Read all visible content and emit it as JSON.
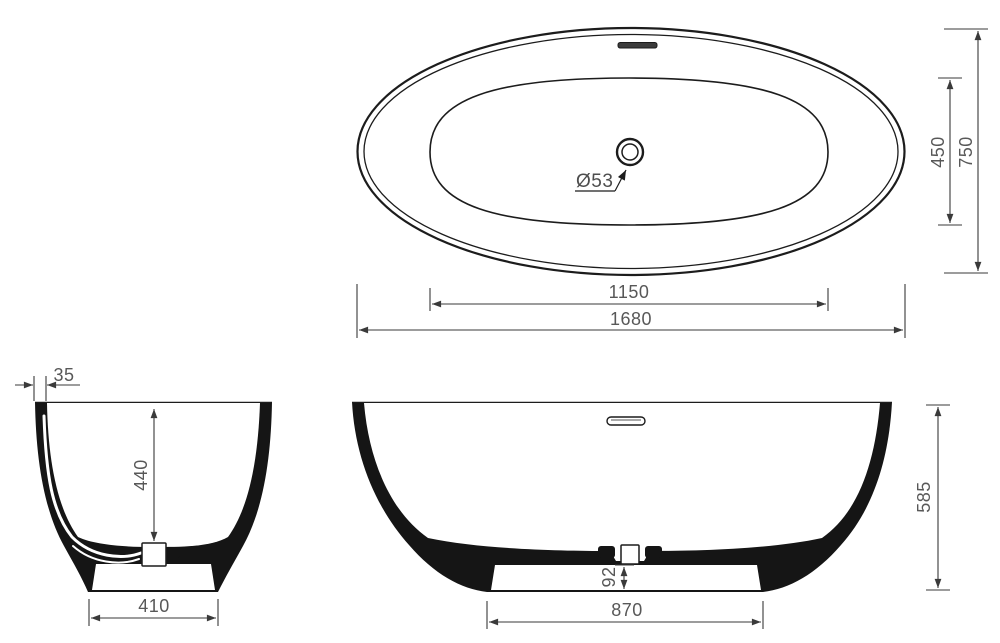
{
  "drawing": {
    "subject": "freestanding-oval-bathtub-technical-drawing",
    "background_color": "#ffffff",
    "outline_color": "#1c1c1c",
    "dimension_line_color": "#3a3a3a",
    "dimension_text_color": "#585858",
    "views": {
      "plan": {
        "name": "plan-view",
        "dimensions": {
          "inner_length": "1150",
          "overall_length": "1680",
          "inner_width": "450",
          "overall_width": "750",
          "drain_diameter": "Ø53"
        }
      },
      "end_section": {
        "name": "end-cross-section",
        "dimensions": {
          "rim_thickness": "35",
          "inner_depth": "440",
          "base_width": "410"
        }
      },
      "side_section": {
        "name": "longitudinal-cross-section",
        "dimensions": {
          "overall_height": "585",
          "base_height": "92",
          "base_length": "870"
        }
      }
    }
  }
}
